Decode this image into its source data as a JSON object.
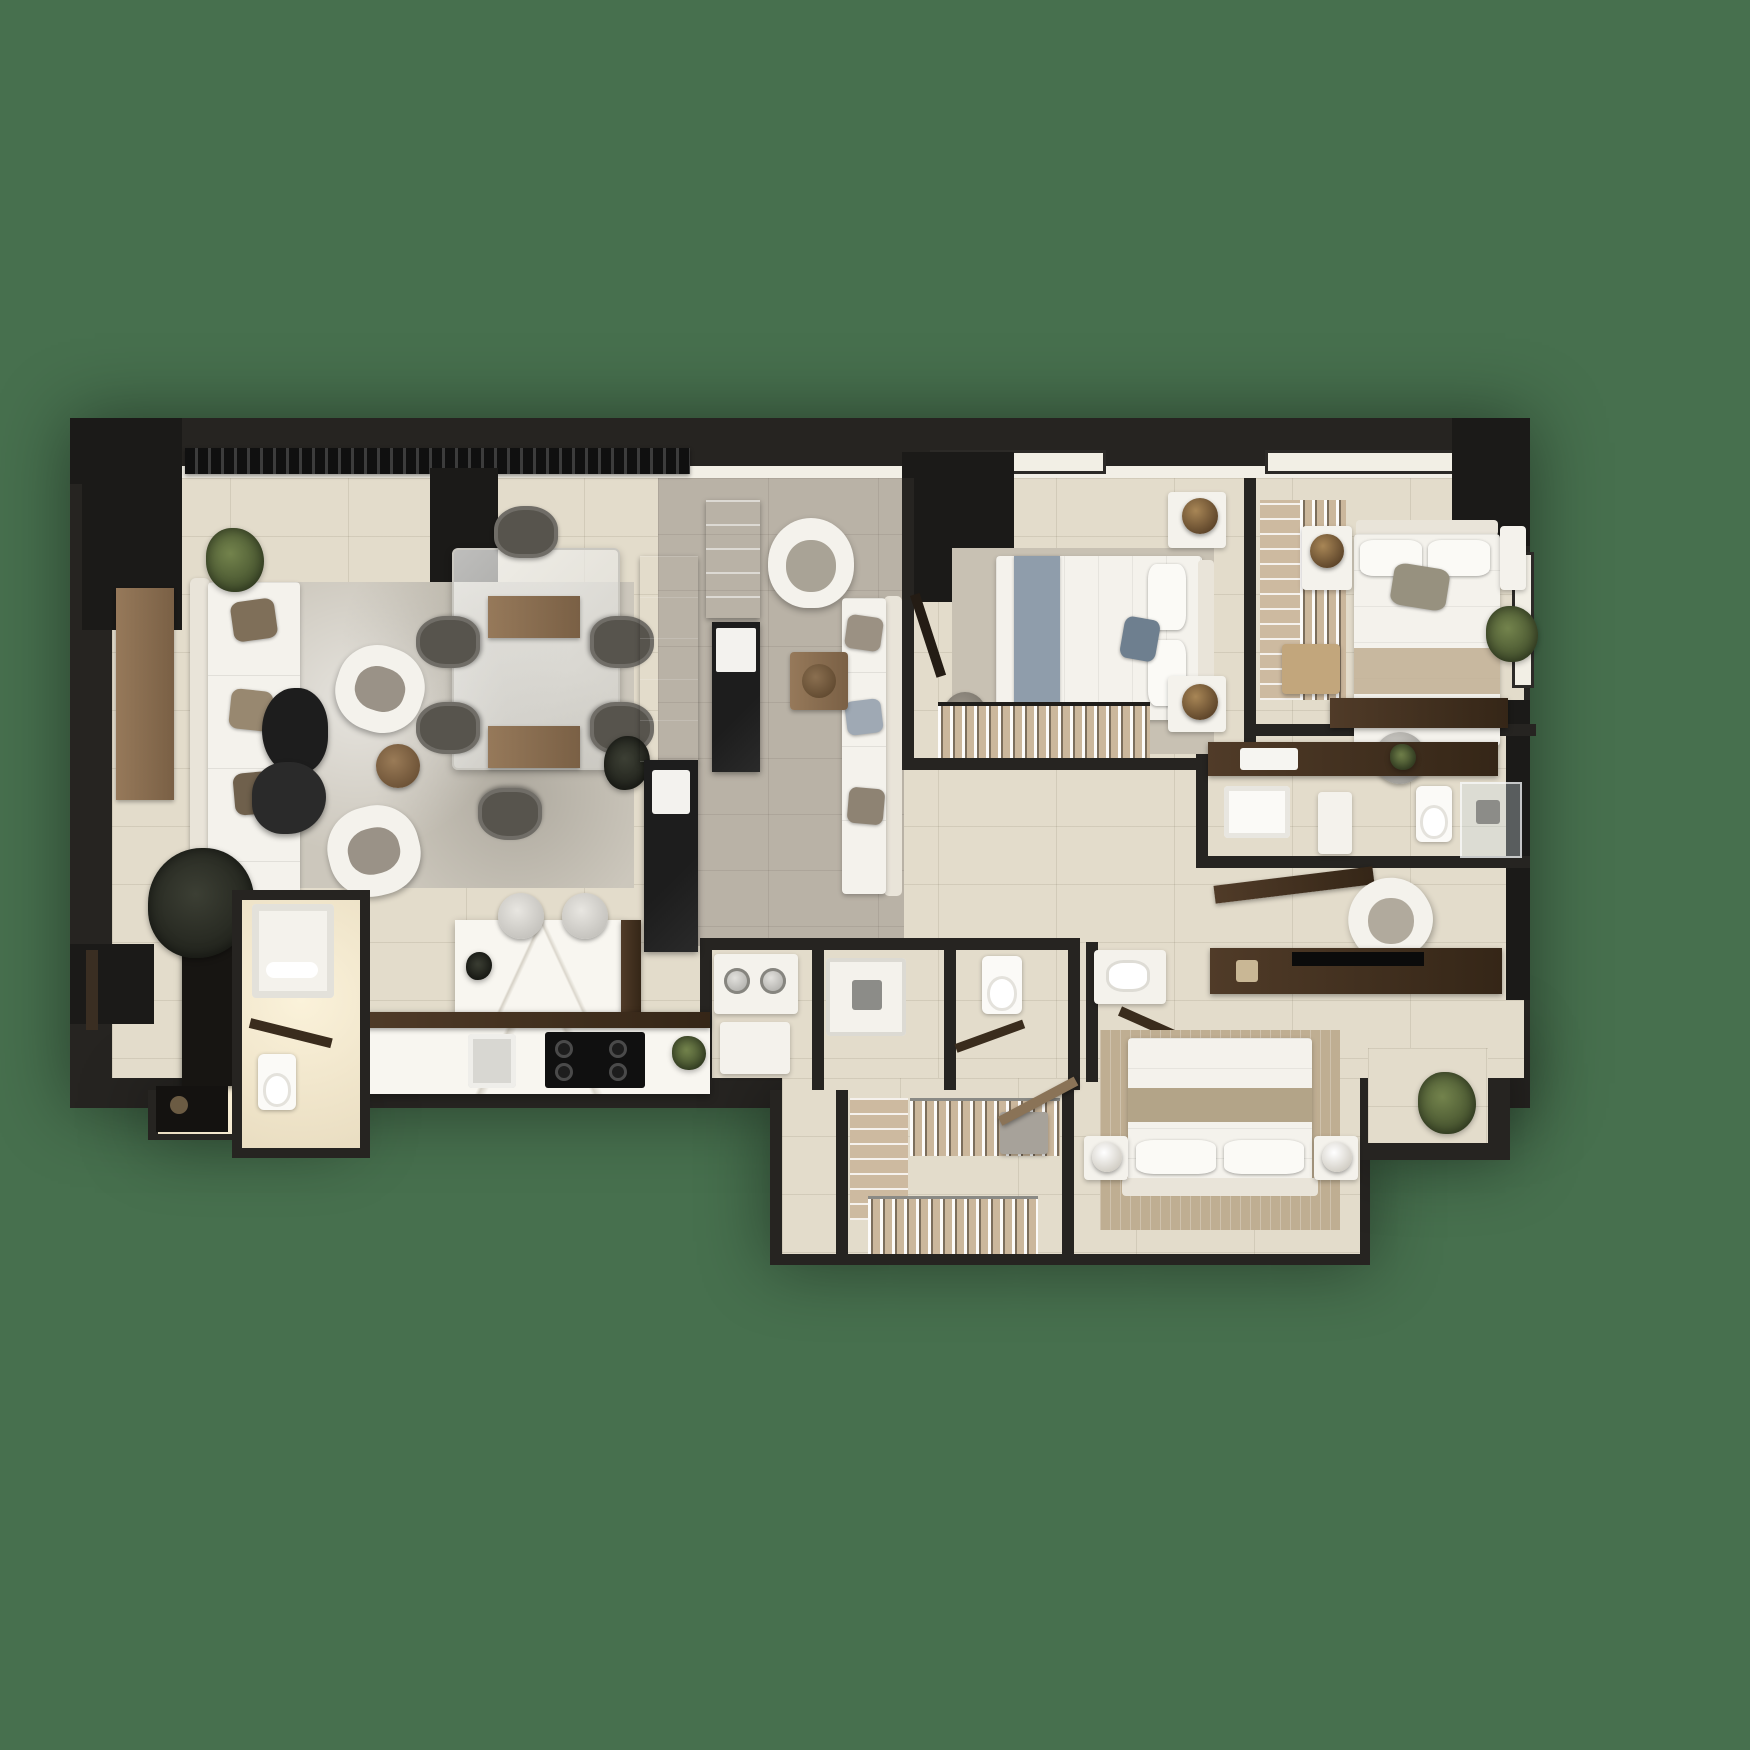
{
  "scene": {
    "type": "apartment-floor-plan-3d-render",
    "view": "top-down",
    "background": "#47704e",
    "no_visible_text": true
  },
  "palette": {
    "bg": "#47704e",
    "wall": "#262421",
    "wall-deep": "#1b1a18",
    "floor": "#e3dccb",
    "floor-warm": "#f0e7d0",
    "floor-gray": "#b9b2a6",
    "rug": "#ccc7bc",
    "rug-bed": "#c8c1b3",
    "rug-tan": "#bfae92",
    "white-furn": "#f4f2ec",
    "ivory": "#e9e4d9",
    "marble": "#f8f6f0",
    "black-marble": "#161616",
    "wood": "#8a6f52",
    "wood-dark": "#4a3627",
    "wood-deep": "#2c2016",
    "brass": "#8a6b40",
    "chair-gray": "#57544d",
    "pillow-brown": "#7f6f59",
    "blue-gray": "#8f9dab",
    "plant": "#5c6e42",
    "plant-dark": "#30332b",
    "steel": "#b5b3ae"
  },
  "rooms": [
    {
      "name": "living-room",
      "furniture": [
        "l-shaped-white-sofa",
        "brown-pillows",
        "dark-coffee-tables",
        "round-wood-side-table",
        "white-armchair-x2",
        "area-rug",
        "wood-sideboard",
        "dark-tall-cabinet",
        "dark-plant",
        "corner-plant",
        "entry-console"
      ]
    },
    {
      "name": "dining-area",
      "furniture": [
        "glass-dining-table",
        "wood-runner-x2",
        "gray-chair-x6",
        "plant"
      ]
    },
    {
      "name": "kitchen",
      "furniture": [
        "marble-island",
        "bar-stool-x2",
        "marble-counter",
        "black-cooktop",
        "sink",
        "fridge",
        "herb-plant",
        "tall-wood-cabinet",
        "black-marble-bar"
      ]
    },
    {
      "name": "den",
      "furniture": [
        "curved-white-chair",
        "wall-sofa",
        "pillows",
        "wood-shelf",
        "black-cabinet",
        "square-side-table"
      ]
    },
    {
      "name": "bedroom-1",
      "furniture": [
        "double-bed-blue-runner",
        "nightstand-with-brass-lamp-x2",
        "area-rug",
        "pouf",
        "wardrobe-with-hangers",
        "door"
      ]
    },
    {
      "name": "bedroom-2",
      "furniture": [
        "double-bed-with-laptop",
        "nightstand-with-brass-lamp-x2",
        "open-closet-racks",
        "bench",
        "desk",
        "metal-desk-chair",
        "balcony-plant"
      ]
    },
    {
      "name": "bathroom-right",
      "furniture": [
        "dark-wood-vanity",
        "sink",
        "toilet",
        "glass-shower",
        "tub-bench"
      ]
    },
    {
      "name": "corridor-right",
      "furniture": [
        "angled-shelf",
        "round-lounge-chair",
        "tv-console",
        "tv"
      ]
    },
    {
      "name": "bedroom-3",
      "furniture": [
        "double-bed-tan-band",
        "nightstand-with-white-lamp-x2",
        "tan-rug",
        "plant",
        "vanity-sink"
      ]
    },
    {
      "name": "laundry-and-baths",
      "furniture": [
        "washer-with-dials",
        "white-cabinet",
        "shower-tray",
        "shower-head",
        "toilet"
      ]
    },
    {
      "name": "walk-in-closet",
      "furniture": [
        "hanging-clothes-rail-x2",
        "shelf-stack",
        "storage-box"
      ]
    },
    {
      "name": "bathroom-left",
      "furniture": [
        "bathtub",
        "toilet",
        "door"
      ]
    },
    {
      "name": "facade",
      "furniture": [
        "louver-pergola",
        "window-x3",
        "entry-door"
      ]
    }
  ]
}
